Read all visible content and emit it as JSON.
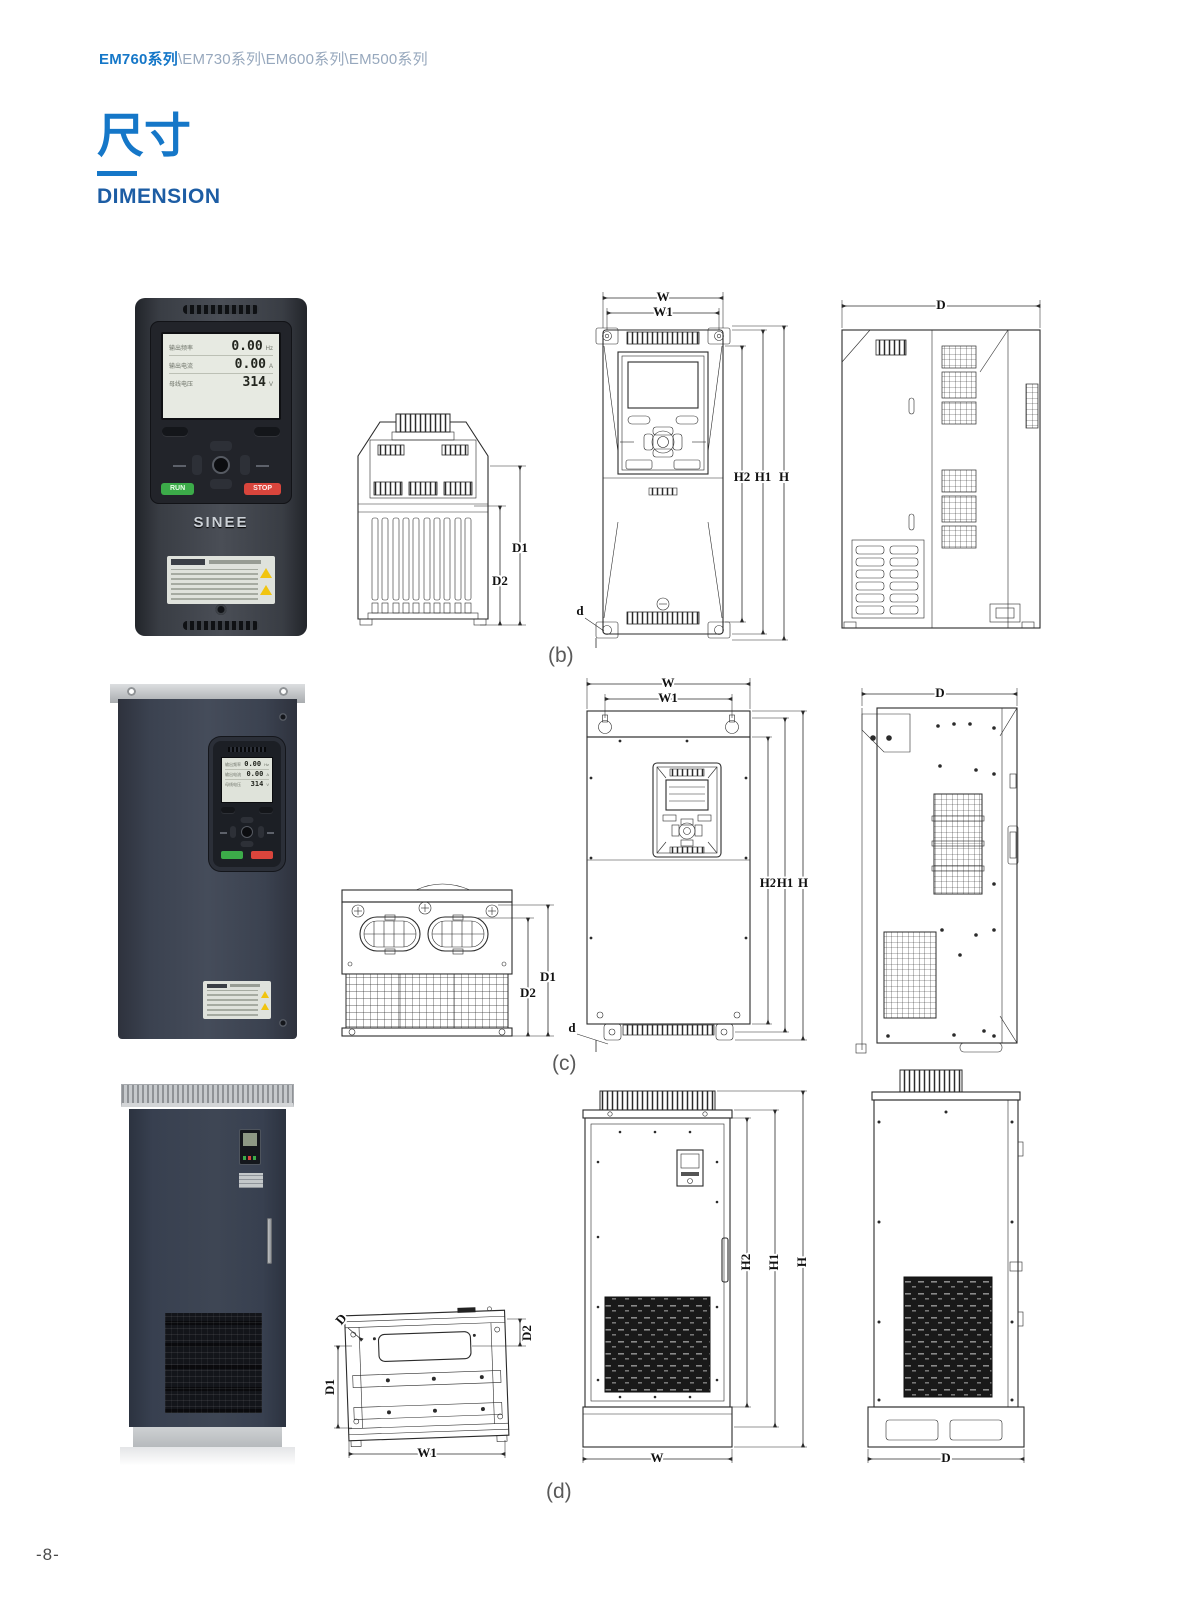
{
  "page": {
    "breadcrumb_primary": "EM760系列",
    "breadcrumb_rest": "\\EM730系列\\EM600系列\\EM500系列",
    "title_cn": "尺寸",
    "title_en": "DIMENSION",
    "page_number": "-8-"
  },
  "colors": {
    "accent_blue": "#1577c8",
    "title_en_blue": "#1d5da4",
    "breadcrumb_gray": "#97a8bd",
    "drawing_line": "#2b2b2b",
    "run_green": "#3cab49",
    "stop_red": "#d9453c",
    "warning_yellow": "#f1c40f"
  },
  "keypad": {
    "brand": "SINEE",
    "run": "RUN",
    "stop": "STOP",
    "rows": [
      {
        "label": "输出频率",
        "value": "0.00",
        "unit": "Hz"
      },
      {
        "label": "输出电流",
        "value": "0.00",
        "unit": "A"
      },
      {
        "label": "母线电压",
        "value": "314",
        "unit": "V"
      }
    ]
  },
  "captions": {
    "b": "(b)",
    "c": "(c)",
    "d": "(d)"
  },
  "dim_labels": {
    "W": "W",
    "W1": "W1",
    "H": "H",
    "H1": "H1",
    "H2": "H2",
    "D": "D",
    "D1": "D1",
    "D2": "D2",
    "d": "d"
  }
}
